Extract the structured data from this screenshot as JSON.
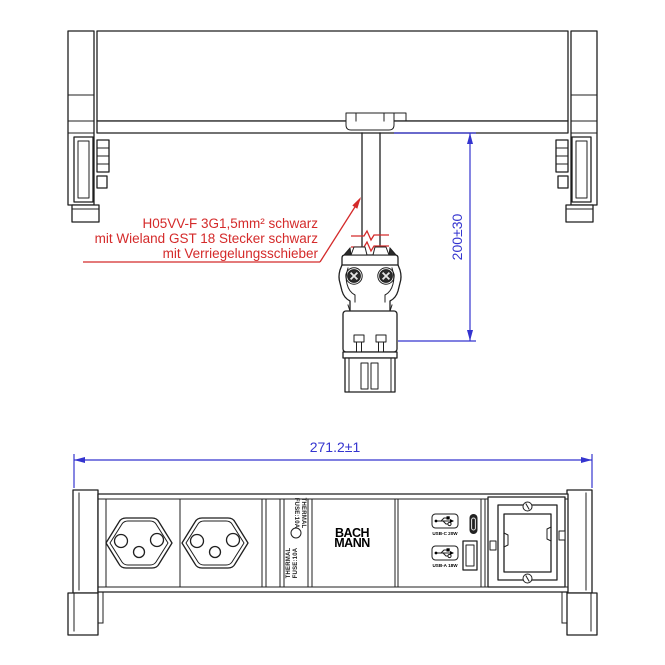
{
  "drawing": {
    "type": "technical-drawing",
    "colors": {
      "line": "#1f1f1f",
      "annotation_red": "#d42a2a",
      "dimension_blue": "#3434cf",
      "background": "#ffffff"
    },
    "top_view": {
      "cable_note_line1": "H05VV-F 3G1,5mm² schwarz",
      "cable_note_line2": "mit Wieland GST 18 Stecker schwarz",
      "cable_note_line3": "mit Verriegelungsschieber",
      "cable_length_dimension": "200±30"
    },
    "bottom_view": {
      "width_dimension": "271.2±1",
      "thermal_fuse_line1": "THERMAL",
      "thermal_fuse_line2": "FUSE:10A",
      "brand_line1": "BACH",
      "brand_line2": "MANN",
      "usb_c_label": "USB-C 20W",
      "usb_a_label": "USB-A 18W"
    }
  }
}
